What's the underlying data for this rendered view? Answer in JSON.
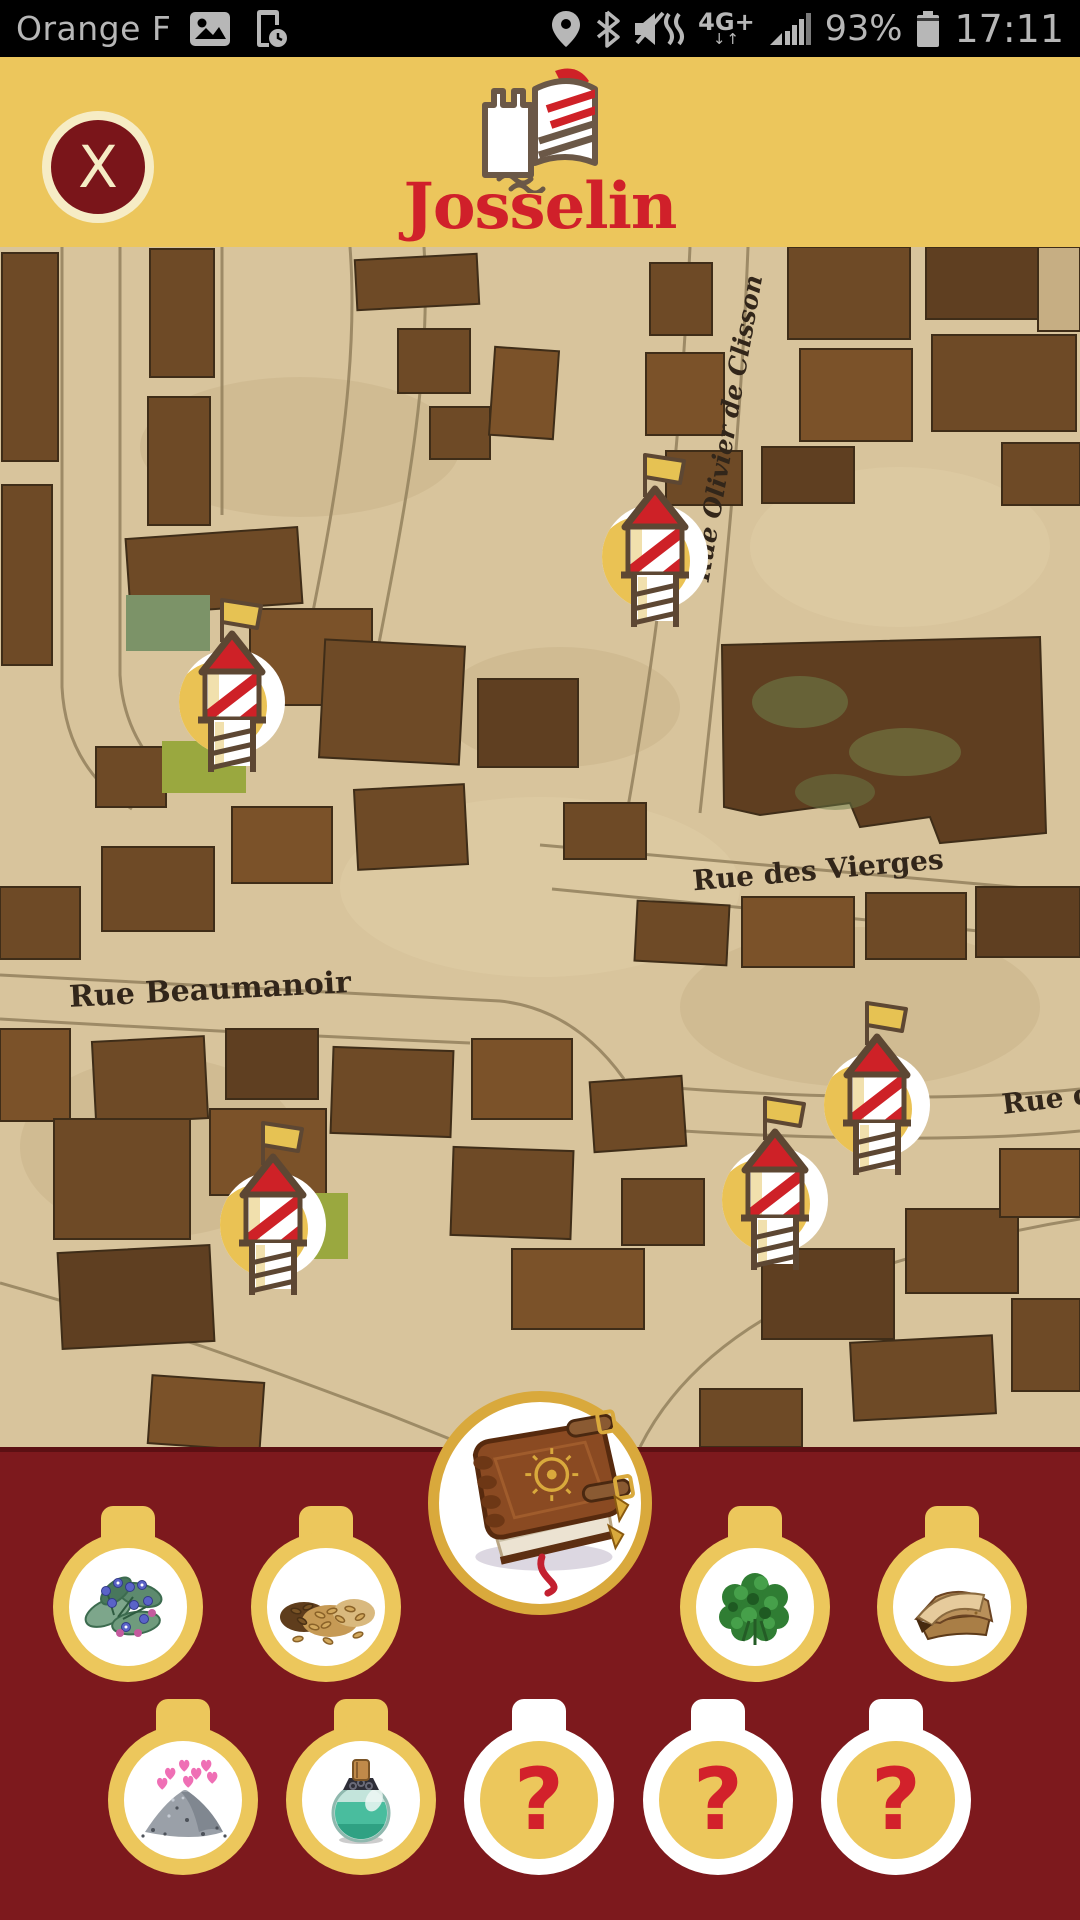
{
  "status_bar": {
    "carrier": "Orange F",
    "network_label": "4G+",
    "network_arrows": "↓↑",
    "battery_percent": "93%",
    "time": "17:11"
  },
  "header": {
    "app_title": "Josselin",
    "close_label": "X"
  },
  "map": {
    "street_labels": [
      {
        "id": "rue-olivier-de-clisson",
        "name": "Rue Olivier de Clisson"
      },
      {
        "id": "rue-des-vierges",
        "name": "Rue des Vierges"
      },
      {
        "id": "rue-beaumanoir",
        "name": "Rue Beaumanoir"
      },
      {
        "id": "rue-de",
        "name": "Rue de"
      }
    ],
    "markers": [
      {
        "id": "watchtower-1"
      },
      {
        "id": "watchtower-2"
      },
      {
        "id": "watchtower-3"
      },
      {
        "id": "watchtower-4"
      },
      {
        "id": "watchtower-5"
      }
    ]
  },
  "inventory": {
    "center_item": {
      "id": "grimoire-book",
      "state": "found"
    },
    "row1": [
      {
        "id": "flowers",
        "state": "found"
      },
      {
        "id": "seeds",
        "state": "found"
      },
      {
        "id": "herbs",
        "state": "found"
      },
      {
        "id": "leather",
        "state": "found"
      }
    ],
    "row2": [
      {
        "id": "love-powder",
        "state": "found"
      },
      {
        "id": "potion",
        "state": "found"
      },
      {
        "id": "unknown-1",
        "state": "unknown",
        "label": "?"
      },
      {
        "id": "unknown-2",
        "state": "unknown",
        "label": "?"
      },
      {
        "id": "unknown-3",
        "state": "unknown",
        "label": "?"
      }
    ]
  },
  "colors": {
    "header_yellow": "#ecc65c",
    "title_red": "#d0202a",
    "panel_maroon": "#7d191d",
    "close_maroon": "#7a151a",
    "medallion_gold": "#ecc75c",
    "ring_gold": "#d9a93c",
    "map_parchment": "#d8c49c",
    "map_building": "#6e4a26",
    "question_red": "#d2212b"
  }
}
